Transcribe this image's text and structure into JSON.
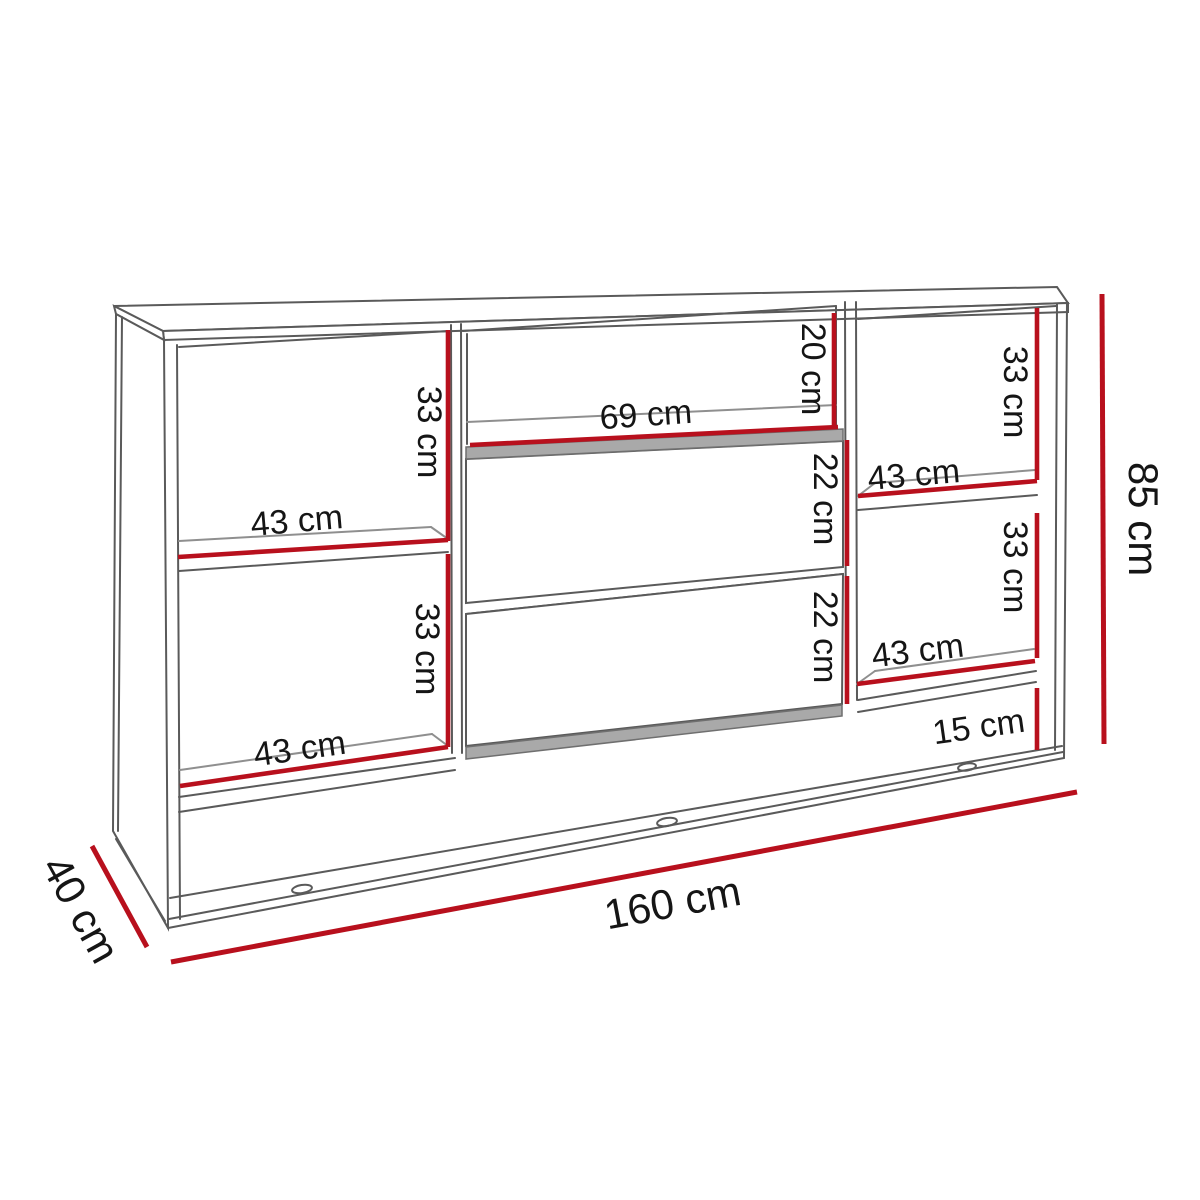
{
  "diagram": {
    "name": "sideboard-dimension-diagram",
    "unit": "cm",
    "colors": {
      "dimension_red": "#b8101d",
      "outline_gray": "#5a5a5a",
      "interior_gray": "#8f8f8f",
      "shading_gray": "#a9a9a9",
      "text": "#151515",
      "background": "#ffffff"
    },
    "overall": {
      "width": "160 cm",
      "height": "85 cm",
      "depth": "40 cm",
      "plinth_clearance": "15 cm"
    },
    "compartments": {
      "left_upper": {
        "height": "33 cm",
        "shelf_width": "43 cm"
      },
      "left_lower": {
        "height": "33 cm",
        "shelf_width": "43 cm"
      },
      "middle_niche": {
        "width": "69 cm",
        "height": "20 cm"
      },
      "drawer_top": {
        "height": "22 cm"
      },
      "drawer_bottom": {
        "height": "22 cm"
      },
      "right_upper": {
        "height": "33 cm",
        "shelf_width": "43 cm"
      },
      "right_lower": {
        "height": "33 cm",
        "shelf_width": "43 cm"
      }
    }
  }
}
